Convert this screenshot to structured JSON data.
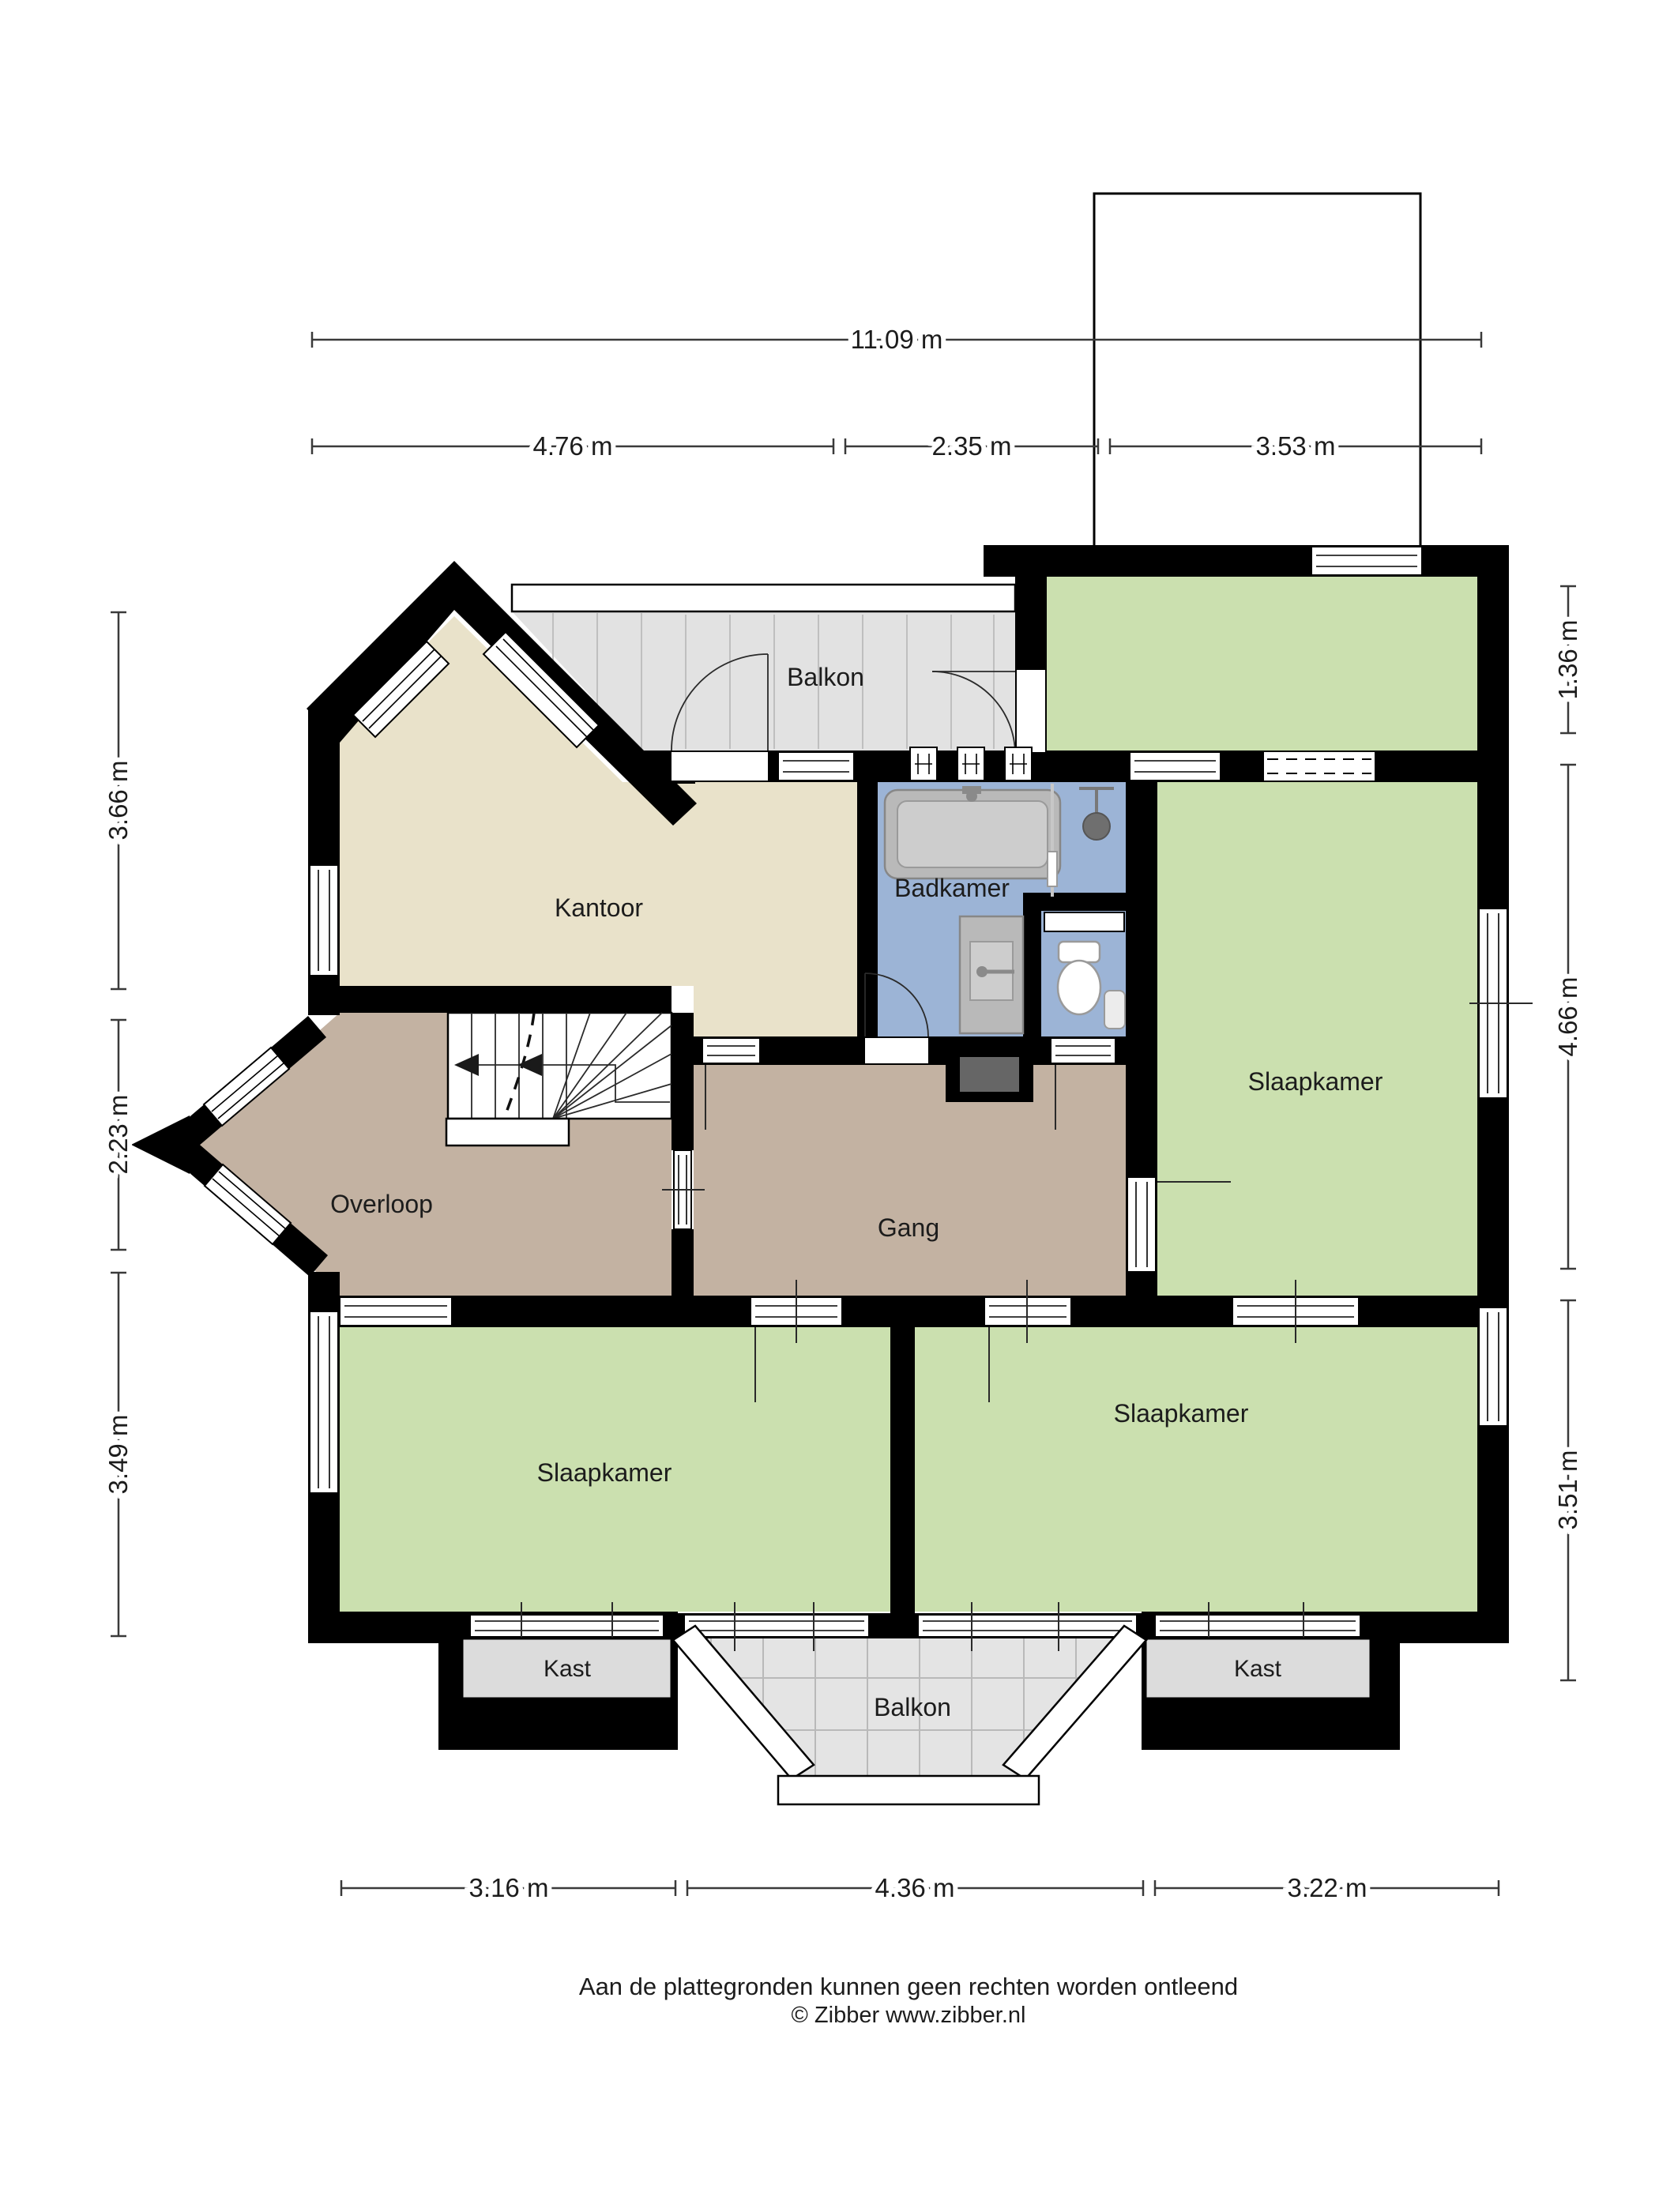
{
  "plan": {
    "title_hidden": "",
    "rooms": {
      "balkon_top": "Balkon",
      "kantoor": "Kantoor",
      "badkamer": "Badkamer",
      "slaapkamer_right": "Slaapkamer",
      "overloop": "Overloop",
      "gang": "Gang",
      "slaapkamer_bottom_left": "Slaapkamer",
      "slaapkamer_bottom_right": "Slaapkamer",
      "kast_left": "Kast",
      "kast_right": "Kast",
      "balkon_bottom": "Balkon"
    },
    "dimensions": {
      "top_total": "11.09 m",
      "top_segments": [
        "4.76 m",
        "2.35 m",
        "3.53 m"
      ],
      "left": [
        "3.66 m",
        "2.23 m",
        "3.49 m"
      ],
      "right": [
        "1.36 m",
        "4.66 m",
        "3.51 m"
      ],
      "bottom": [
        "3.16 m",
        "4.36 m",
        "3.22 m"
      ]
    },
    "footer": {
      "disclaimer": "Aan de plattegronden kunnen geen rechten worden ontleend",
      "copyright": "© Zibber www.zibber.nl"
    },
    "colors": {
      "wall": "#000000",
      "kantoor": "#e9e2ca",
      "hallway": "#c3b2a2",
      "bedroom": "#cbe0af",
      "bathroom": "#9cb4d6",
      "balcony": "#e2e2e2",
      "closet": "#dcdcdc",
      "shaft": "#666666"
    }
  }
}
